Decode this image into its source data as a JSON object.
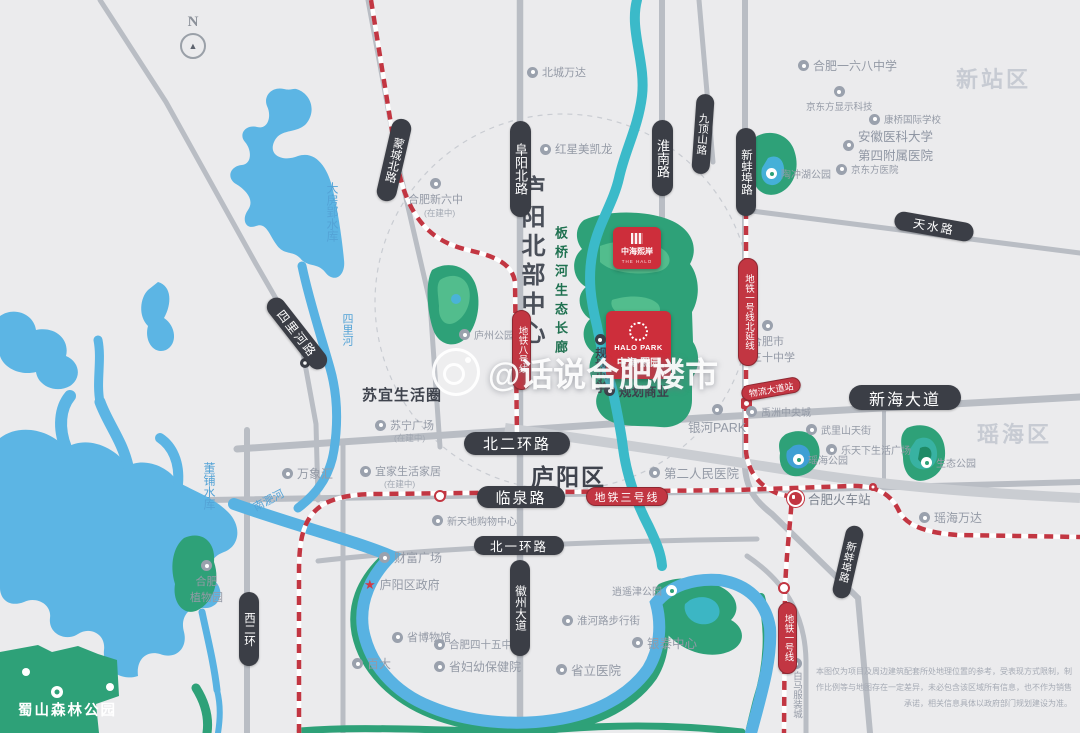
{
  "watermark": {
    "handle": "@话说合肥楼市"
  },
  "compass": {
    "north": "N"
  },
  "districts": {
    "xinzhan": "新站区",
    "yaohai": "瑶海区",
    "luyang": "庐阳区"
  },
  "areas": {
    "luyang_north_center": "庐阳北部中心",
    "banqiao_corridor": "板桥河生态长廊",
    "suyi_circle": "苏宜生活圈"
  },
  "roads": {
    "mengcheng_north": "蒙城北路",
    "fuyang_north": "阜阳北路",
    "huainan": "淮南路",
    "jiudingshan": "九顶山路",
    "xinbengbu": "新蚌埠路",
    "tianshui": "天水路",
    "silihe": "四里河路",
    "xierhuan": "西二环",
    "beierhuan": "北二环路",
    "xinhai_avenue": "新海大道",
    "linquan": "临泉路",
    "beiyihuan": "北一环路",
    "huizhou_avenue": "徽州大道",
    "xinbengbu_south": "新蚌埠路"
  },
  "metro": {
    "line1_north_ext": "地铁一号线北延线",
    "line8": "地铁八号线",
    "line3": "地铁三号线",
    "line1": "地铁一号线",
    "wuliu_station": "物流大道站"
  },
  "projects": {
    "halo_cn": "中海熙岸",
    "halo_en": "THE HALO",
    "halopark_en": "HALO PARK",
    "halopark_cn": "中海·熙园",
    "planned_school": "规划小学",
    "planned_commercial": "规划商业"
  },
  "water": {
    "dafangying": "大房郢水库",
    "dongpu": "董铺水库",
    "silihe": "四里河",
    "nanfeihe": "南淝河"
  },
  "parks": {
    "taochonghu": "陶冲湖公园",
    "luzhou": "庐州公园",
    "shushan": "蜀山森林公园",
    "yaohai": "瑶海公园",
    "shengtai": "生态公园",
    "xiaoyaojin": "逍遥津公园"
  },
  "pois": {
    "beicheng_wanda": "北城万达",
    "hefei_xinliuzhong": "合肥新六中",
    "under_construction": "(在建中)",
    "hongxing_meikailong": "红星美凯龙",
    "hefei_168_school": "合肥一六八中学",
    "boe_tech": "京东方显示科技",
    "kangqiao_school": "康桥国际学校",
    "anyida_line1": "安徽医科大学",
    "anyida_line2": "第四附属医院",
    "boe_hospital": "京东方医院",
    "suning_plaza": "苏宁广场",
    "wanxianghui": "万象汇",
    "ikea": "宜家生活家居",
    "xintiandi": "新天地购物中心",
    "caifu_plaza": "财富广场",
    "luyang_gov": "庐阳区政府",
    "museum": "省博物馆",
    "baida": "百大",
    "hefei_45_school": "合肥四十五中学",
    "fuyou_hospital": "省妇幼保健院",
    "shengli_hospital": "省立医院",
    "huaihe_street": "淮河路步行街",
    "yintai_center": "银泰中心",
    "yinhe_park": "银河PARK",
    "second_hospital": "第二人民医院",
    "yuzhou_central": "禹洲中央城",
    "wulishan": "武里山天街",
    "letianxia": "乐天下生活广场",
    "hefei_station": "合肥火车站",
    "yaohai_wanda": "瑶海万达",
    "no30_line1": "合肥市",
    "no30_line2": "第三十中学",
    "baima": "白马服装城",
    "botanical_line1": "合肥",
    "botanical_line2": "植物园"
  },
  "disclaimer": {
    "line1": "本图仅为项目及周边建筑配套所处地理位置的参考，受表现方式限制，制",
    "line2": "作比例等与地图存在一定差异，未必包含该区域所有信息，也不作为销售",
    "line3": "承诺，相关信息具体以政府部门规划建设为准。"
  }
}
